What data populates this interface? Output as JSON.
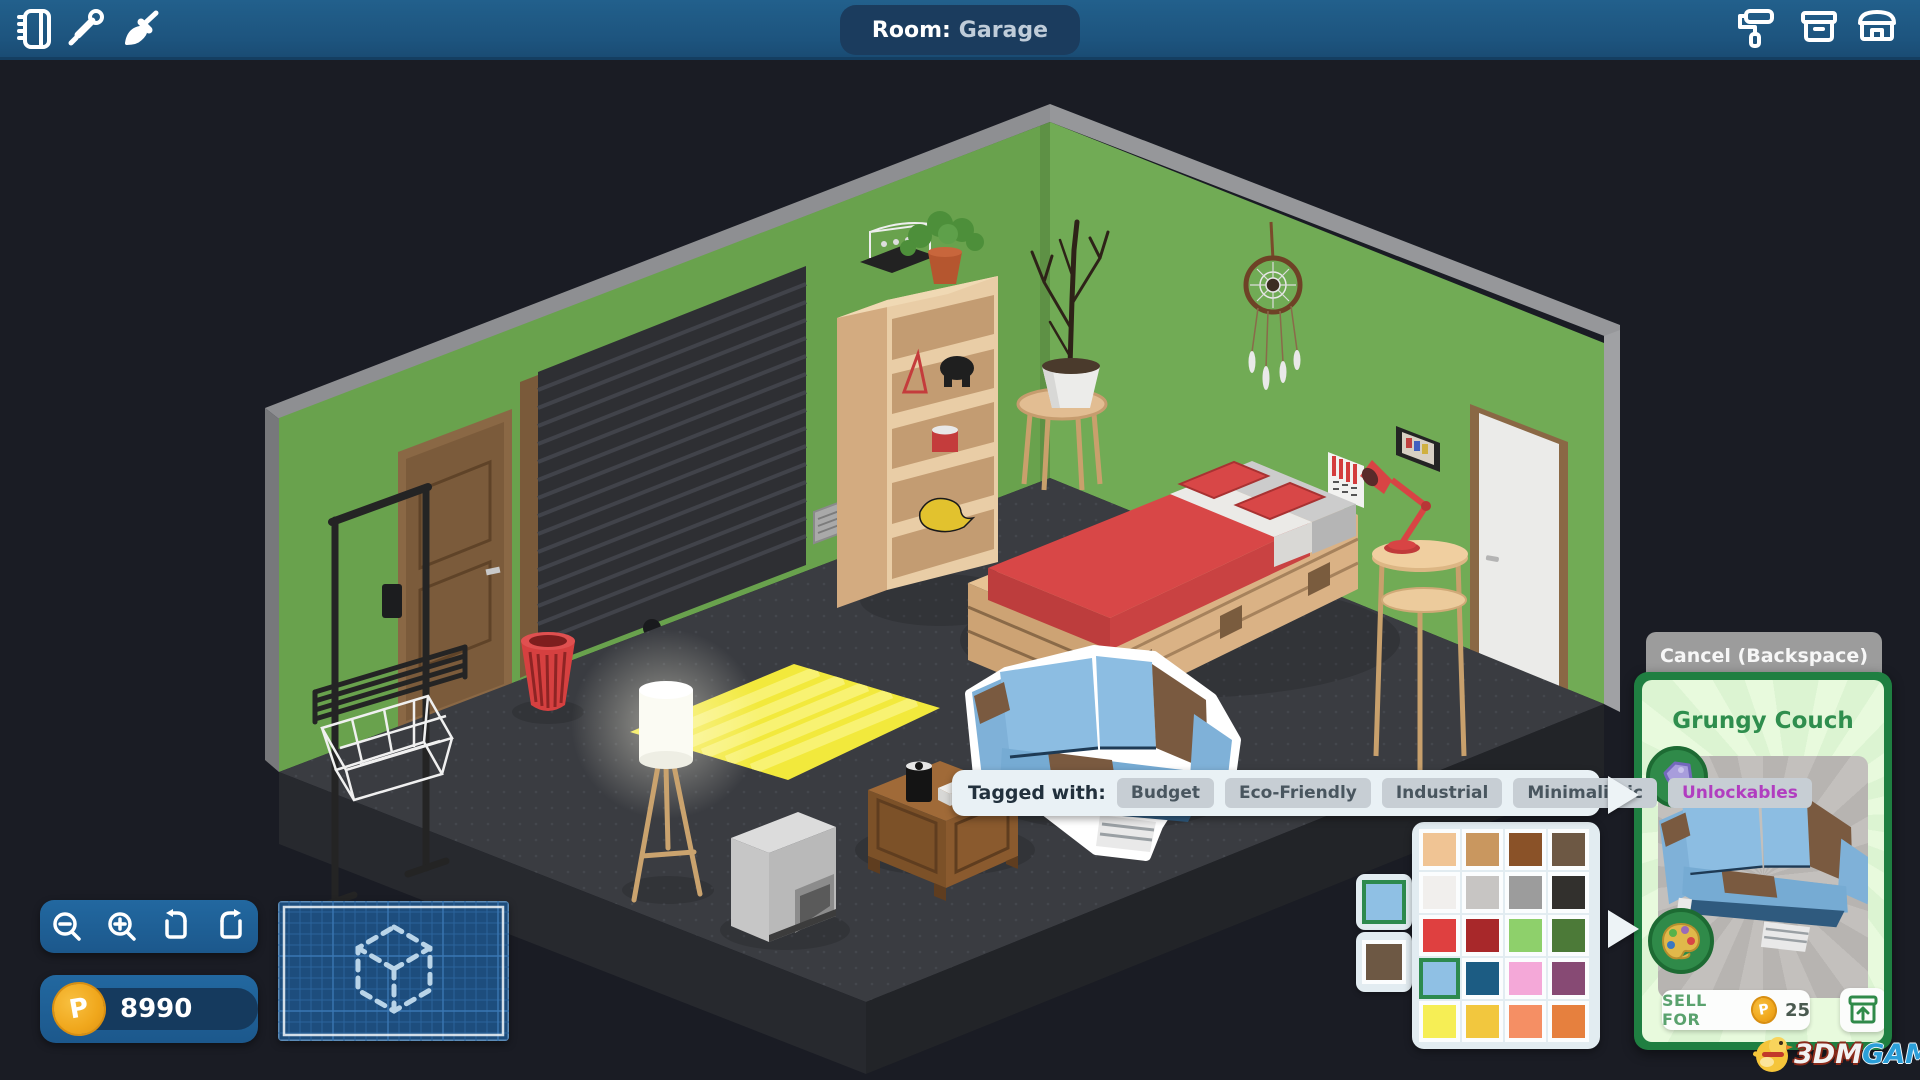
{
  "topbar": {
    "room_label": "Room:",
    "room_name": "Garage",
    "left_icons": [
      "journal-icon",
      "eyedropper-icon",
      "paintbrush-icon"
    ],
    "right_icons": [
      "paint-roller-icon",
      "storage-box-icon",
      "shop-icon"
    ]
  },
  "tooltip": {
    "label": "Tagged with:",
    "tags": [
      {
        "label": "Budget",
        "highlight": false
      },
      {
        "label": "Eco-Friendly",
        "highlight": false
      },
      {
        "label": "Industrial",
        "highlight": false
      },
      {
        "label": "Minimalistic",
        "highlight": false
      },
      {
        "label": "Unlockables",
        "highlight": true
      }
    ],
    "highlight_color": "#b13dc0"
  },
  "palette": {
    "current": [
      {
        "color": "#8fc0e4",
        "selected": true
      },
      {
        "color": "#6d5844",
        "selected": false
      }
    ],
    "grid": [
      "#f0c494",
      "#c9975f",
      "#8a5228",
      "#6d5844",
      "#f1efed",
      "#c7c5c3",
      "#9c9c9c",
      "#32302d",
      "#df4040",
      "#a8282a",
      "#8ed06b",
      "#4c7a38",
      "#8fc0e4",
      "#1c5c83",
      "#f4a8d8",
      "#874a74",
      "#f6ee55",
      "#f2c73e",
      "#f58f64",
      "#e6803e"
    ],
    "selected_index": 12,
    "selected_border": "#2d8a4e"
  },
  "item_panel": {
    "cancel_label": "Cancel (Backspace)",
    "item_name": "Grungy Couch",
    "sell_label": "SELL FOR",
    "sell_price": "25",
    "coin_letter": "P",
    "accent_green": "#1f7f41"
  },
  "hud": {
    "currency": "8990",
    "coin_letter": "P",
    "zoom_icons": [
      "zoom-out-icon",
      "zoom-in-icon",
      "rotate-left-icon",
      "rotate-right-icon"
    ]
  },
  "watermark": {
    "part1": "3DM",
    "part2": "GAME"
  },
  "scene": {
    "items": [
      "garage-roller-door",
      "wooden-door",
      "clothes-rack",
      "wire-basket",
      "red-trash-can",
      "bookshelf",
      "potted-plant",
      "plant-stand",
      "dreamcatcher",
      "pallet-bed",
      "desk-lamp",
      "side-table",
      "calendar",
      "picture-frame",
      "white-door",
      "yellow-rug",
      "floor-lamp",
      "crt-tv",
      "nightstand",
      "speaker",
      "grungy-couch"
    ]
  }
}
